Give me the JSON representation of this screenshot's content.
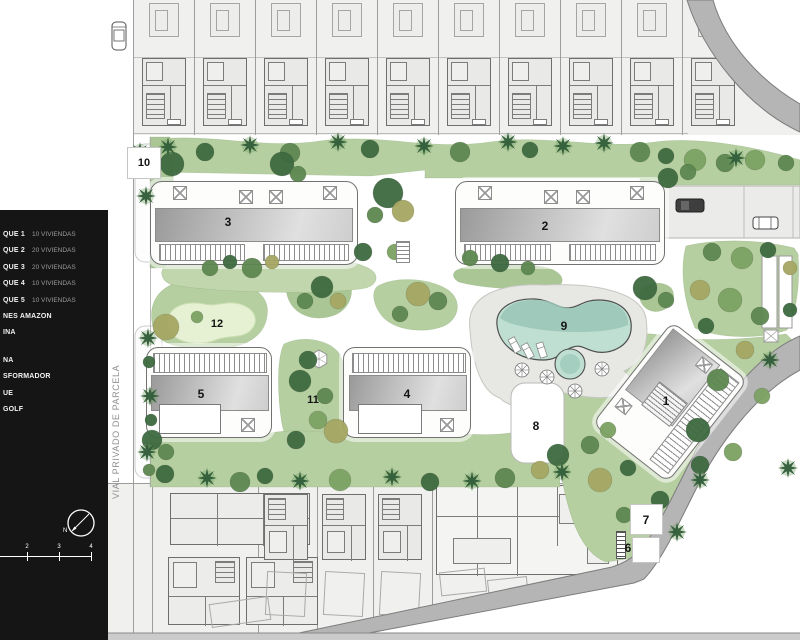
{
  "site_plan": {
    "map_labels": [
      {
        "text": "1"
      },
      {
        "text": "2"
      },
      {
        "text": "3"
      },
      {
        "text": "4"
      },
      {
        "text": "5"
      },
      {
        "text": "6"
      },
      {
        "text": "7"
      },
      {
        "text": "8"
      },
      {
        "text": "9"
      },
      {
        "text": "10"
      },
      {
        "text": "11"
      },
      {
        "text": "12"
      }
    ],
    "legend": {
      "items": [
        {
          "name": "QUE 1",
          "detail": "10 VIVIENDAS"
        },
        {
          "name": "QUE 2",
          "detail": "20 VIVIENDAS"
        },
        {
          "name": "QUE 3",
          "detail": "20 VIVIENDAS"
        },
        {
          "name": "QUE 4",
          "detail": "10 VIVIENDAS"
        },
        {
          "name": "QUE 5",
          "detail": "10 VIVIENDAS"
        },
        {
          "name": "NES AMAZON",
          "detail": ""
        },
        {
          "name": "INA",
          "detail": ""
        },
        {
          "name": "NA",
          "detail": ""
        },
        {
          "name": "SFORMADOR",
          "detail": ""
        },
        {
          "name": "UE",
          "detail": ""
        },
        {
          "name": "GOLF",
          "detail": ""
        }
      ]
    },
    "road_label": "VIAL PRIVADO DE PARCELA",
    "compass": {
      "north_label": "N"
    },
    "scale_bar": {
      "ticks": [
        "2",
        "3",
        "4"
      ]
    }
  },
  "colors": {
    "path": "#e9e9e6",
    "band": "#f0f0ee",
    "grass": "#b6cfa1",
    "grass2": "#a9c694",
    "grass3": "#c1d6ad",
    "putting": "#e6f0d2",
    "pool": "#bfdfd3",
    "pool_dark": "#99c6b6",
    "deck": "#e7e7e4",
    "road": "#b5b5b5",
    "road_edge": "#7d7d7d",
    "strip": "#cbcbcb",
    "legend_bg": "#151515",
    "legend_text": "#f2f2f2",
    "legend_muted": "#9b9b9b",
    "tree_dark": "#3e6a40",
    "tree_mid": "#5d8750",
    "tree_light": "#7ca263",
    "olive": "#a6a763",
    "palm": "#2f5c38",
    "label": "#141414",
    "white": "#ffffff"
  }
}
